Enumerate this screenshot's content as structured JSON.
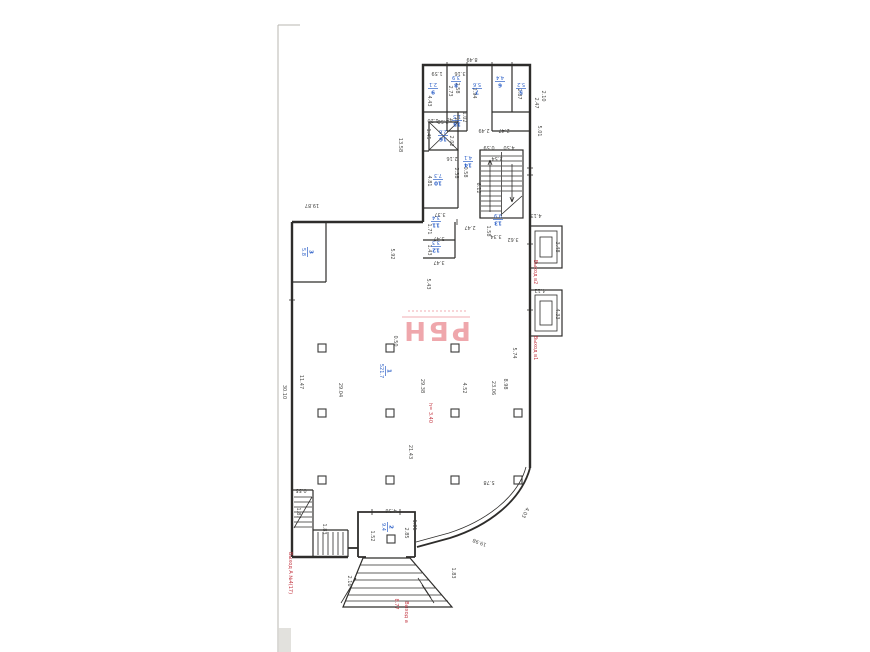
{
  "stamp": {
    "text": "РБН"
  },
  "dims": [
    {
      "t": "8.49",
      "x": 472,
      "y": 58,
      "r": 180
    },
    {
      "t": "13.58",
      "x": 399,
      "y": 145,
      "r": 90
    },
    {
      "t": "19.87",
      "x": 312,
      "y": 204,
      "r": 180
    },
    {
      "t": "30.10",
      "x": 283,
      "y": 392,
      "r": 90
    },
    {
      "t": "11.47",
      "x": 300,
      "y": 382,
      "r": 90
    },
    {
      "t": "1.59",
      "x": 437,
      "y": 72,
      "r": 180
    },
    {
      "t": "3.16",
      "x": 460,
      "y": 72,
      "r": 180
    },
    {
      "t": "4.43",
      "x": 428,
      "y": 101,
      "r": 90
    },
    {
      "t": "2.73",
      "x": 449,
      "y": 91,
      "r": 90
    },
    {
      "t": "2.58",
      "x": 456,
      "y": 88,
      "r": 90
    },
    {
      "t": "2.94",
      "x": 473,
      "y": 93,
      "r": 90
    },
    {
      "t": "2.87",
      "x": 518,
      "y": 94,
      "r": 90
    },
    {
      "t": "2.49",
      "x": 484,
      "y": 129,
      "r": 180
    },
    {
      "t": "2.47",
      "x": 504,
      "y": 129,
      "r": 180
    },
    {
      "t": "1.48",
      "x": 452,
      "y": 118,
      "r": 180
    },
    {
      "t": "1.02",
      "x": 463,
      "y": 117,
      "r": 90
    },
    {
      "t": "1.20",
      "x": 433,
      "y": 119,
      "r": 180
    },
    {
      "t": "1.45",
      "x": 427,
      "y": 134,
      "r": 90
    },
    {
      "t": "2.58",
      "x": 443,
      "y": 120,
      "r": 180
    },
    {
      "t": "2.02",
      "x": 450,
      "y": 141,
      "r": 90
    },
    {
      "t": "2.16",
      "x": 452,
      "y": 157,
      "r": 180
    },
    {
      "t": "2.38",
      "x": 455,
      "y": 173,
      "r": 90
    },
    {
      "t": "0.58",
      "x": 464,
      "y": 172,
      "r": 90
    },
    {
      "t": "4.81",
      "x": 428,
      "y": 181,
      "r": 90
    },
    {
      "t": "3.37",
      "x": 440,
      "y": 213,
      "r": 180
    },
    {
      "t": "1.71",
      "x": 428,
      "y": 229,
      "r": 90
    },
    {
      "t": "3.47",
      "x": 439,
      "y": 237,
      "r": 180
    },
    {
      "t": "1.43",
      "x": 428,
      "y": 250,
      "r": 90
    },
    {
      "t": "3.47",
      "x": 439,
      "y": 261,
      "r": 180
    },
    {
      "t": "0.59",
      "x": 489,
      "y": 146,
      "r": 180
    },
    {
      "t": "4.50",
      "x": 509,
      "y": 146,
      "r": 180
    },
    {
      "t": "2.54",
      "x": 497,
      "y": 157,
      "r": 180
    },
    {
      "t": "6.12",
      "x": 477,
      "y": 188,
      "r": 90
    },
    {
      "t": "2.47",
      "x": 470,
      "y": 226,
      "r": 180
    },
    {
      "t": "1.58",
      "x": 487,
      "y": 231,
      "r": 90
    },
    {
      "t": "3.34",
      "x": 496,
      "y": 235,
      "r": 180
    },
    {
      "t": "3.62",
      "x": 513,
      "y": 238,
      "r": 180
    },
    {
      "t": "2.47",
      "x": 535,
      "y": 103,
      "r": 90
    },
    {
      "t": "2.10",
      "x": 542,
      "y": 96,
      "r": 90
    },
    {
      "t": "5.01",
      "x": 538,
      "y": 131,
      "r": 90
    },
    {
      "t": "4.13",
      "x": 536,
      "y": 214,
      "r": 180
    },
    {
      "t": "3.48",
      "x": 556,
      "y": 247,
      "r": 90
    },
    {
      "t": "4.12",
      "x": 540,
      "y": 289,
      "r": 180
    },
    {
      "t": "4.33",
      "x": 556,
      "y": 314,
      "r": 90
    },
    {
      "t": "5.92",
      "x": 391,
      "y": 254,
      "r": 90
    },
    {
      "t": "5.43",
      "x": 427,
      "y": 284,
      "r": 90
    },
    {
      "t": "29.04",
      "x": 339,
      "y": 390,
      "r": 90
    },
    {
      "t": "29.38",
      "x": 421,
      "y": 386,
      "r": 90
    },
    {
      "t": "4.52",
      "x": 463,
      "y": 388,
      "r": 90
    },
    {
      "t": "23.06",
      "x": 492,
      "y": 388,
      "r": 90
    },
    {
      "t": "21.43",
      "x": 409,
      "y": 452,
      "r": 90
    },
    {
      "t": "5.74",
      "x": 513,
      "y": 353,
      "r": 90
    },
    {
      "t": "8.98",
      "x": 504,
      "y": 384,
      "r": 90
    },
    {
      "t": "5.78",
      "x": 489,
      "y": 481,
      "r": 180
    },
    {
      "t": "0.50",
      "x": 394,
      "y": 341,
      "r": 90
    },
    {
      "t": "0.55",
      "x": 301,
      "y": 489,
      "r": 180
    },
    {
      "t": "1.87",
      "x": 297,
      "y": 513,
      "r": 90
    },
    {
      "t": "1.83",
      "x": 323,
      "y": 529,
      "r": 90
    },
    {
      "t": "4.36",
      "x": 391,
      "y": 509,
      "r": 180
    },
    {
      "t": "1.52",
      "x": 371,
      "y": 536,
      "r": 90
    },
    {
      "t": "2.85",
      "x": 405,
      "y": 533,
      "r": 90
    },
    {
      "t": "1.01",
      "x": 413,
      "y": 525,
      "r": 90
    },
    {
      "t": "2.16",
      "x": 348,
      "y": 581,
      "r": 90
    },
    {
      "t": "1.83",
      "x": 452,
      "y": 573,
      "r": 90
    },
    {
      "t": "19.98",
      "x": 480,
      "y": 541,
      "r": 200
    },
    {
      "t": "4.03",
      "x": 524,
      "y": 512,
      "r": 115
    }
  ],
  "room_labels": [
    {
      "n": "1",
      "a": "521.7",
      "x": 386,
      "y": 371,
      "r": 90
    },
    {
      "n": "2",
      "a": "9.4",
      "x": 388,
      "y": 527,
      "r": 90
    },
    {
      "n": "3",
      "a": "5.8",
      "x": 308,
      "y": 252,
      "r": 90
    },
    {
      "n": "9",
      "a": "2.1",
      "x": 433,
      "y": 89,
      "r": 180
    },
    {
      "n": "8",
      "a": "3.9",
      "x": 456,
      "y": 82,
      "r": 180
    },
    {
      "n": "7",
      "a": "5.6",
      "x": 477,
      "y": 89,
      "r": 180
    },
    {
      "n": "6",
      "a": "4.4",
      "x": 500,
      "y": 82,
      "r": 180
    },
    {
      "n": "5",
      "a": "5.2",
      "x": 521,
      "y": 89,
      "r": 180
    },
    {
      "n": "15",
      "a": "1.5",
      "x": 457,
      "y": 121,
      "r": 180
    },
    {
      "n": "16",
      "a": "2.6",
      "x": 443,
      "y": 136,
      "r": 180
    },
    {
      "n": "10",
      "a": "7.3",
      "x": 438,
      "y": 180,
      "r": 180
    },
    {
      "n": "11",
      "a": "3.4",
      "x": 436,
      "y": 222,
      "r": 180
    },
    {
      "n": "12",
      "a": "3.3",
      "x": 436,
      "y": 247,
      "r": 180
    },
    {
      "n": "14",
      "a": "4.1",
      "x": 468,
      "y": 162,
      "r": 180
    },
    {
      "n": "13",
      "a": "9.9",
      "x": 498,
      "y": 220,
      "r": 180
    }
  ],
  "red_labels": [
    {
      "t": "h= 3.40",
      "x": 429,
      "y": 413,
      "r": 90
    },
    {
      "t": "8.77",
      "x": 395,
      "y": 604,
      "r": 90
    },
    {
      "t": "Выход а",
      "x": 405,
      "y": 612,
      "r": 90
    },
    {
      "t": "Выход А №4(17)",
      "x": 289,
      "y": 573,
      "r": 90
    },
    {
      "t": "Выход в2",
      "x": 534,
      "y": 272,
      "r": 90
    },
    {
      "t": "Выход в1",
      "x": 534,
      "y": 348,
      "r": 90
    }
  ],
  "columns": [
    {
      "x": 322,
      "y": 348
    },
    {
      "x": 390,
      "y": 348
    },
    {
      "x": 455,
      "y": 348
    },
    {
      "x": 322,
      "y": 413
    },
    {
      "x": 390,
      "y": 413
    },
    {
      "x": 455,
      "y": 413
    },
    {
      "x": 518,
      "y": 413
    },
    {
      "x": 322,
      "y": 480
    },
    {
      "x": 390,
      "y": 480
    },
    {
      "x": 455,
      "y": 480
    },
    {
      "x": 518,
      "y": 480
    },
    {
      "x": 391,
      "y": 539
    }
  ]
}
